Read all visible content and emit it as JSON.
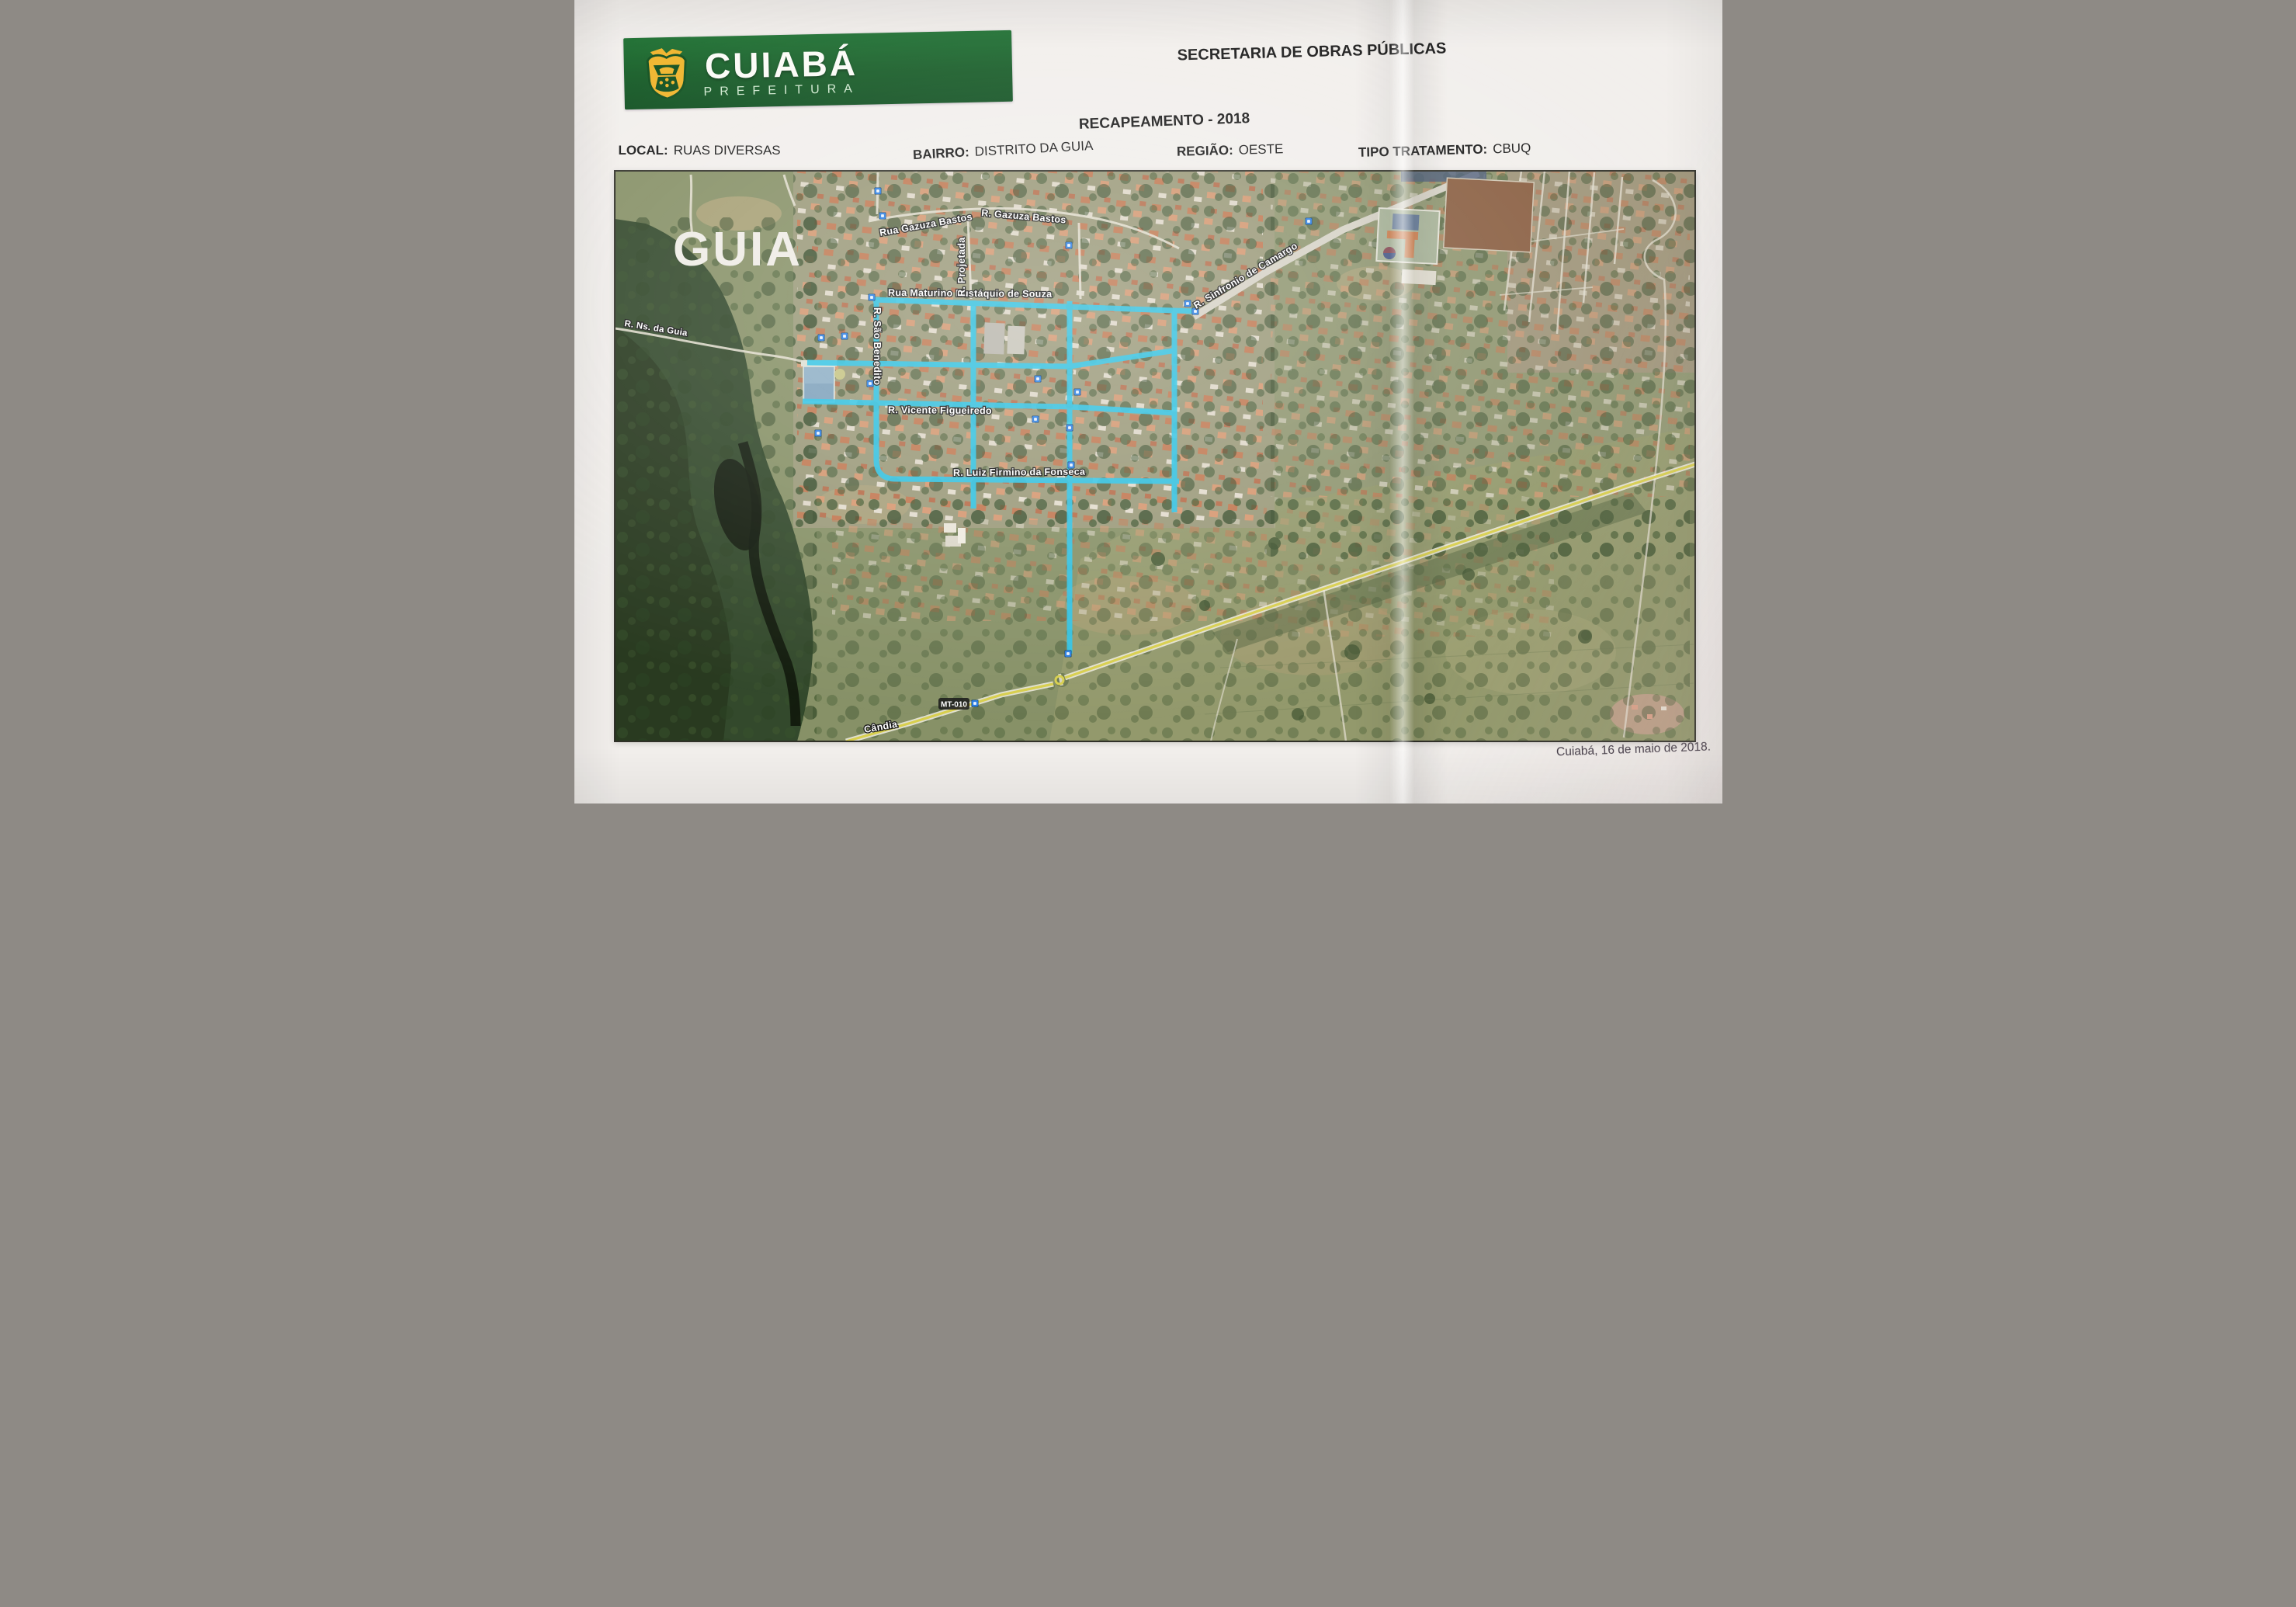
{
  "header": {
    "logo": {
      "title": "CUIABÁ",
      "subtitle": "PREFEITURA",
      "banner_color": "#145a25",
      "crest_color": "#f0b429"
    },
    "department": "SECRETARIA DE OBRAS PÚBLICAS",
    "program": "RECAPEAMENTO - 2018"
  },
  "info": {
    "local_label": "LOCAL:",
    "local_value": "RUAS DIVERSAS",
    "bairro_label": "BAIRRO:",
    "bairro_value": "DISTRITO DA GUIA",
    "regiao_label": "REGIÃO:",
    "regiao_value": "OESTE",
    "tipo_label": "TIPO TRATAMENTO:",
    "tipo_value": "CBUQ"
  },
  "map": {
    "area_label": "GUIA",
    "highlight_color": "#2fc4e6",
    "marker_color": "#2a7de1",
    "road_badge": "MT-010",
    "streets": {
      "gazuza1": "Rua Gazuza Bastos",
      "gazuza2": "R. Gazuza Bastos",
      "maturino": "Rua Maturino Eustáquio de Souza",
      "sinfronio": "R. Sinfronio de Camargo",
      "ns_guia": "R. Ns. da Guia",
      "sao_benedito": "R. São Benedito",
      "projetada": "R. Projetada",
      "vicente": "R. Vicente Figueiredo",
      "fonseca": "R. Luiz Firmino da Fonseca",
      "candia": "Cândia"
    }
  },
  "footer": {
    "date_line": "Cuiabá, 16 de maio de 2018."
  }
}
